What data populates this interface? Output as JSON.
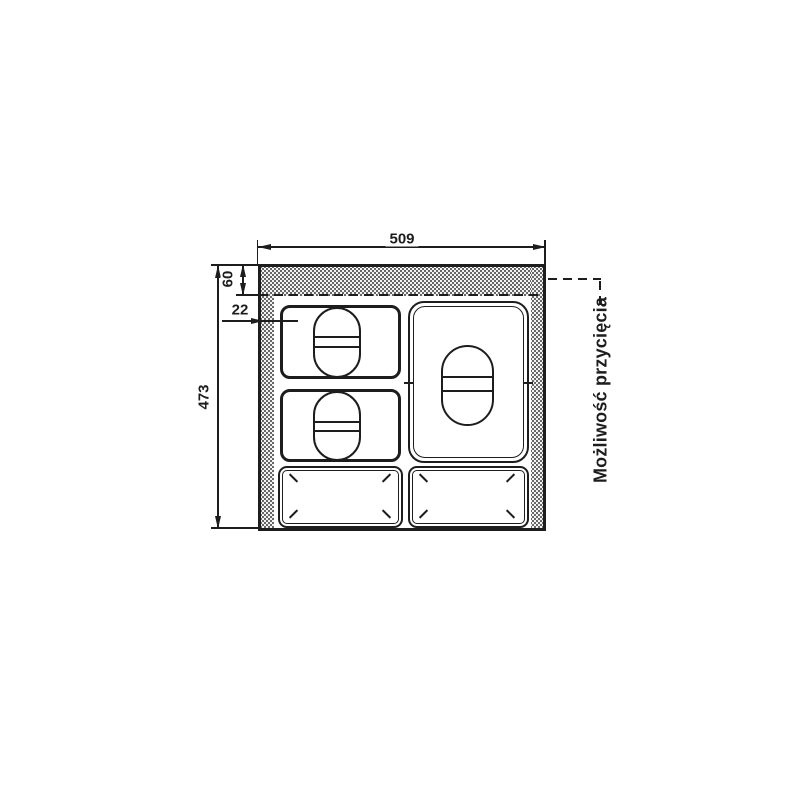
{
  "drawing": {
    "type": "technical-dimension-drawing",
    "dim_width": "509",
    "dim_height": "473",
    "dim_top_band": "60",
    "dim_side_band": "22",
    "trim_note": "Możliwość przycięcia",
    "colors": {
      "line": "#1d1d1d",
      "stipple_bg": "#f3f3f3",
      "stipple_dot": "#474747",
      "background": "#ffffff"
    }
  }
}
